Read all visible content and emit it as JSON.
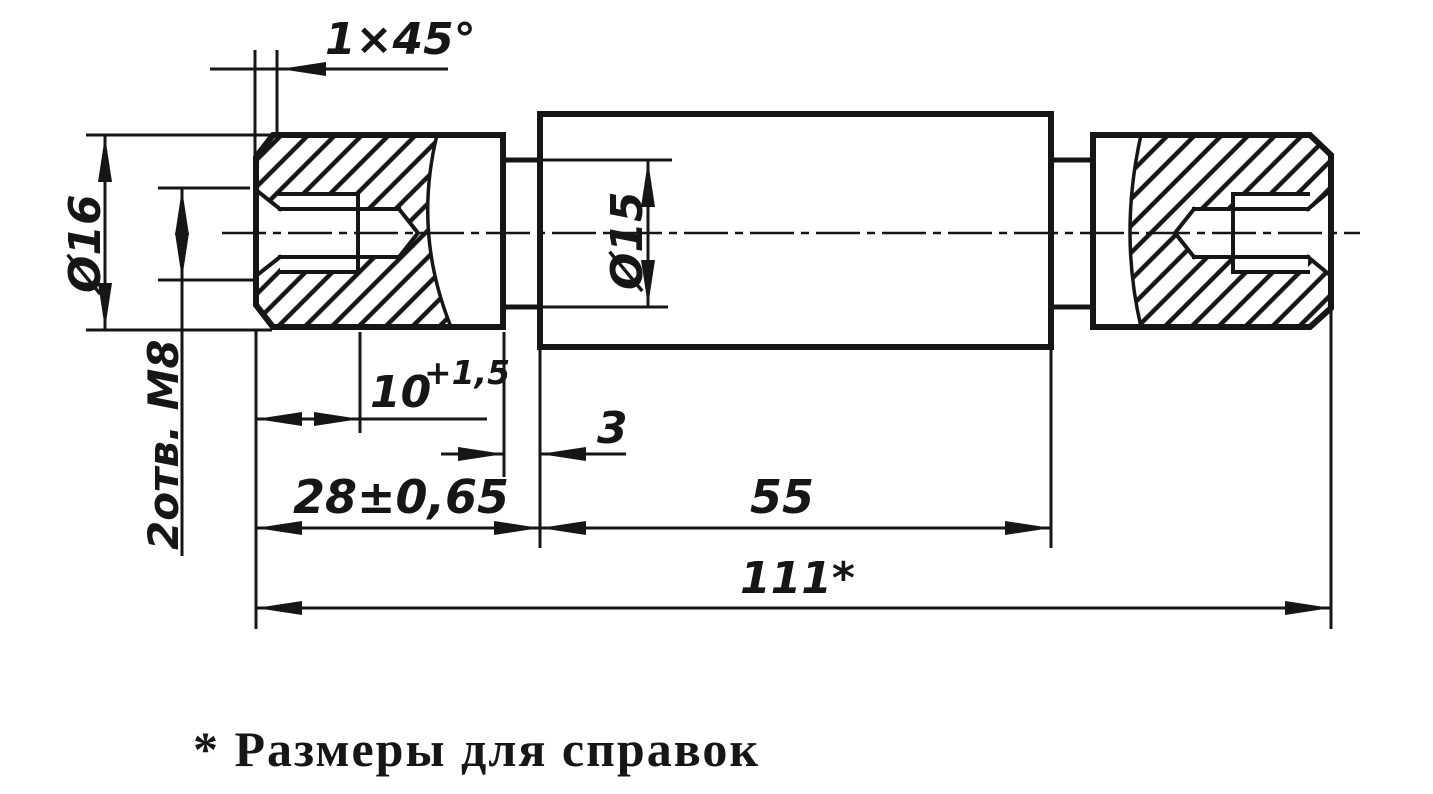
{
  "drawing": {
    "note": "* Размеры для справок",
    "dims": {
      "chamfer": "1×45°",
      "outer_diameter": "Ø16",
      "thread_holes": "2отв. М8",
      "thread_depth": "10",
      "thread_depth_tolerance": "+1,5",
      "neck_width": "3",
      "head_length": "28±0,65",
      "shaft_diameter": "Ø15",
      "body_length": "55",
      "overall_length": "111*"
    },
    "colors": {
      "ink": "#161616",
      "paper": "#ffffff"
    }
  }
}
